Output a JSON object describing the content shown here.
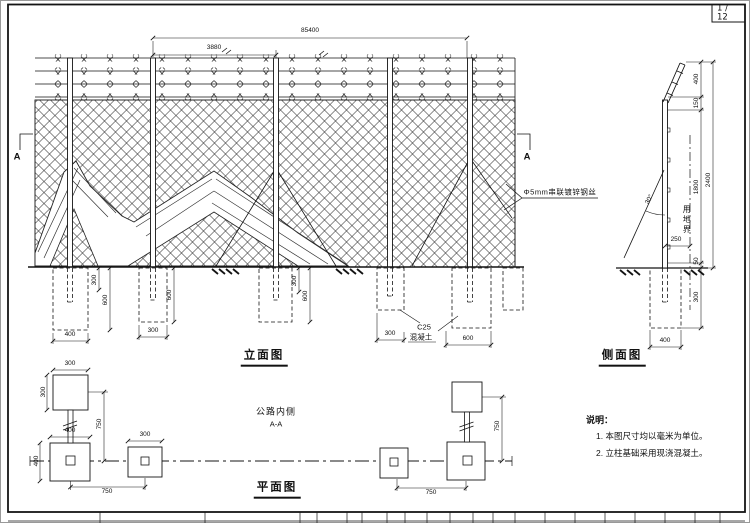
{
  "page": {
    "number": "1 / 12"
  },
  "drawing": {
    "elevation": {
      "title": "立面图",
      "section_marker": "A",
      "wire_callout": "Φ5mm串联镀锌钢丝",
      "concrete_callout": {
        "grade": "C25",
        "material": "混凝土"
      },
      "dims": {
        "overall": "85400",
        "bay": "3880",
        "f1_shaft_depth": "300",
        "f1_depth": "600",
        "f1_width": "400",
        "f2_depth": "600",
        "f2_width": "300",
        "f3_shaft_depth": "300",
        "f3_depth": "600",
        "f5_width": "300",
        "f4_width": "600"
      }
    },
    "side": {
      "title": "侧面图",
      "boundary_label": "用地界",
      "angle": "30°",
      "dims": {
        "arm": "400",
        "gap": "150",
        "mesh_height": "1800",
        "clearance": "50",
        "total_height": "2400",
        "embed_depth": "300",
        "offset": "250",
        "footing_width": "400"
      }
    },
    "plan": {
      "title": "平面图",
      "road_side": "公路内侧",
      "section_cut": "A-A",
      "dims": {
        "anchor_width": "300",
        "anchor_height": "300",
        "stay_length": "750",
        "footing_width": "400",
        "footing_height": "400",
        "post_spacing": "750",
        "mid_width": "300",
        "stay_length_2": "750",
        "post_spacing_2": "750"
      }
    }
  },
  "notes": {
    "heading": "说明：",
    "items": [
      "1. 本图尺寸均以毫米为单位。",
      "2. 立柱基础采用现浇混凝土。"
    ]
  }
}
